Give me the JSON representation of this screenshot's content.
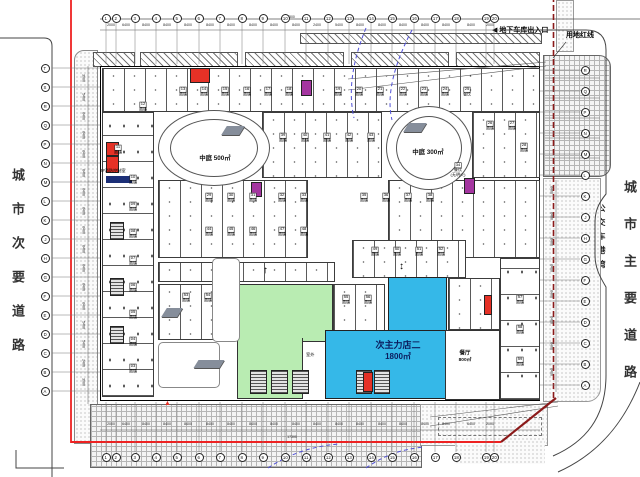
{
  "colors": {
    "store_green": "#b9ecb2",
    "store_blue": "#35b8e8",
    "highlight_red": "#e53126",
    "highlight_magenta": "#a435a0",
    "highlight_navy": "#1c2f77",
    "property_line_red": "#ee2222",
    "property_line_dark_red": "#8b1a1a",
    "turning_path_blue": "#5050d8"
  },
  "roads": {
    "left": "城市次要道路",
    "right": "城市主要道路",
    "bus_bay": "公交车港湾"
  },
  "labels": {
    "garage": "◀ 地下车库出入口",
    "red_line": "用地红线",
    "fire_control": "2#消防控制室",
    "outdoor": "室外",
    "dim_top": "17300",
    "dim_bottom": "17300",
    "atrium_left": "中庭 500㎡",
    "atrium_right": "中庭 300㎡",
    "store_blue_name": "次主力店二",
    "store_blue_area": "1800㎡",
    "restaurant_name": "餐厅",
    "restaurant_area": "800㎡"
  },
  "icons": {
    "arrow_up": "↑",
    "arrow_updown": "↕",
    "marker_red": "▲"
  },
  "grid": {
    "top": {
      "numbers": [
        "1",
        "2",
        "3",
        "4",
        "5",
        "6",
        "7",
        "8",
        "9",
        "10",
        "11",
        "12",
        "13",
        "14",
        "15",
        "16",
        "17",
        "18",
        "19",
        "20"
      ],
      "x": [
        106,
        116,
        135,
        156,
        177,
        199,
        220,
        242,
        263,
        285,
        306,
        328,
        349,
        371,
        392,
        414,
        435,
        456,
        486,
        494
      ],
      "y": 18
    },
    "bottom": {
      "numbers": [
        "1",
        "2",
        "3",
        "4",
        "5",
        "6",
        "7",
        "8",
        "9",
        "10",
        "11",
        "12",
        "13",
        "14",
        "15",
        "16",
        "17",
        "18",
        "19",
        "20"
      ],
      "x": [
        106,
        116,
        135,
        156,
        177,
        199,
        220,
        242,
        263,
        285,
        306,
        328,
        349,
        371,
        392,
        414,
        435,
        456,
        486,
        494
      ],
      "y": 457
    },
    "left": {
      "letters": [
        "T",
        "S",
        "R",
        "Q",
        "P",
        "N",
        "M",
        "L",
        "K",
        "J",
        "H",
        "G",
        "F",
        "E",
        "D",
        "C",
        "B",
        "A"
      ],
      "y": [
        68,
        87,
        106,
        125,
        144,
        163,
        182,
        201,
        220,
        239,
        258,
        277,
        296,
        315,
        334,
        353,
        372,
        391
      ],
      "x": 45
    },
    "right": {
      "letters": [
        "R",
        "Q",
        "P",
        "N",
        "M",
        "L",
        "K",
        "J",
        "H",
        "G",
        "F",
        "E",
        "D",
        "C",
        "B",
        "A"
      ],
      "y": [
        70,
        91,
        112,
        133,
        154,
        175,
        196,
        217,
        238,
        259,
        280,
        301,
        322,
        343,
        364,
        385
      ],
      "x": 585
    },
    "dims_top": [
      "2000",
      "6400",
      "8400",
      "8400",
      "8400",
      "8400",
      "8400",
      "8400",
      "8400",
      "8400",
      "2400",
      "5400",
      "8400",
      "8400",
      "8400",
      "8400",
      "8400",
      "8400",
      "2000"
    ],
    "dims_bottom": [
      "2000",
      "6400",
      "8400",
      "8400",
      "8400",
      "8400",
      "8400",
      "8400",
      "8400",
      "8400",
      "8400",
      "8400",
      "8400",
      "8400",
      "8400",
      "8400",
      "8400",
      "6400",
      "2000"
    ],
    "dims_left": [
      "3900",
      "5400",
      "8400",
      "8400",
      "8400",
      "8400",
      "8400",
      "8400",
      "8400",
      "8400",
      "8400",
      "8400",
      "8400",
      "5400",
      "5400",
      "2400",
      "3900"
    ],
    "dims_right": [
      "8400",
      "8400",
      "8400",
      "8400",
      "8400",
      "8400",
      "8400",
      "8400"
    ]
  },
  "shops": [
    {
      "n": "13",
      "x": 183,
      "y": 92
    },
    {
      "n": "14",
      "x": 204,
      "y": 92
    },
    {
      "n": "15",
      "x": 225,
      "y": 92
    },
    {
      "n": "16",
      "x": 247,
      "y": 92
    },
    {
      "n": "17",
      "x": 268,
      "y": 92
    },
    {
      "n": "18",
      "x": 289,
      "y": 92
    },
    {
      "n": "19",
      "x": 338,
      "y": 92
    },
    {
      "n": "20",
      "x": 359,
      "y": 92
    },
    {
      "n": "21",
      "x": 380,
      "y": 92
    },
    {
      "n": "22",
      "x": 403,
      "y": 92
    },
    {
      "n": "23",
      "x": 424,
      "y": 92
    },
    {
      "n": "24",
      "x": 445,
      "y": 92
    },
    {
      "n": "25",
      "x": 467,
      "y": 92,
      "t": "餐饮"
    },
    {
      "n": "12",
      "x": 143,
      "y": 107
    },
    {
      "n": "11",
      "x": 118,
      "y": 150
    },
    {
      "n": "10",
      "x": 133,
      "y": 180
    },
    {
      "n": "09",
      "x": 133,
      "y": 207
    },
    {
      "n": "08",
      "x": 133,
      "y": 234
    },
    {
      "n": "07",
      "x": 133,
      "y": 261
    },
    {
      "n": "06",
      "x": 133,
      "y": 288
    },
    {
      "n": "05",
      "x": 133,
      "y": 315
    },
    {
      "n": "04",
      "x": 133,
      "y": 342
    },
    {
      "n": "03",
      "x": 133,
      "y": 369
    },
    {
      "n": "39",
      "x": 283,
      "y": 138
    },
    {
      "n": "40",
      "x": 305,
      "y": 138
    },
    {
      "n": "41",
      "x": 327,
      "y": 138
    },
    {
      "n": "42",
      "x": 349,
      "y": 138
    },
    {
      "n": "43",
      "x": 371,
      "y": 138
    },
    {
      "n": "26",
      "x": 490,
      "y": 126
    },
    {
      "n": "27",
      "x": 512,
      "y": 126
    },
    {
      "n": "28",
      "x": 524,
      "y": 148
    },
    {
      "n": "34",
      "x": 458,
      "y": 170,
      "t": "餐饮",
      "t2": "(无明火)"
    },
    {
      "n": "29",
      "x": 209,
      "y": 198
    },
    {
      "n": "30",
      "x": 231,
      "y": 198
    },
    {
      "n": "31",
      "x": 253,
      "y": 198
    },
    {
      "n": "32",
      "x": 282,
      "y": 198
    },
    {
      "n": "33",
      "x": 304,
      "y": 198
    },
    {
      "n": "35",
      "x": 364,
      "y": 198
    },
    {
      "n": "36",
      "x": 386,
      "y": 198
    },
    {
      "n": "37",
      "x": 408,
      "y": 198
    },
    {
      "n": "38",
      "x": 430,
      "y": 198
    },
    {
      "n": "44",
      "x": 209,
      "y": 232
    },
    {
      "n": "45",
      "x": 231,
      "y": 232
    },
    {
      "n": "46",
      "x": 253,
      "y": 232
    },
    {
      "n": "47",
      "x": 282,
      "y": 232
    },
    {
      "n": "48",
      "x": 304,
      "y": 232
    },
    {
      "n": "49",
      "x": 375,
      "y": 252
    },
    {
      "n": "50",
      "x": 397,
      "y": 252
    },
    {
      "n": "51",
      "x": 419,
      "y": 252
    },
    {
      "n": "52",
      "x": 441,
      "y": 252
    },
    {
      "n": "53",
      "x": 186,
      "y": 298
    },
    {
      "n": "54",
      "x": 208,
      "y": 298
    },
    {
      "n": "55",
      "x": 346,
      "y": 300
    },
    {
      "n": "56",
      "x": 368,
      "y": 300
    },
    {
      "n": "57",
      "x": 520,
      "y": 300
    },
    {
      "n": "58",
      "x": 520,
      "y": 330
    },
    {
      "n": "59",
      "x": 520,
      "y": 362
    }
  ]
}
